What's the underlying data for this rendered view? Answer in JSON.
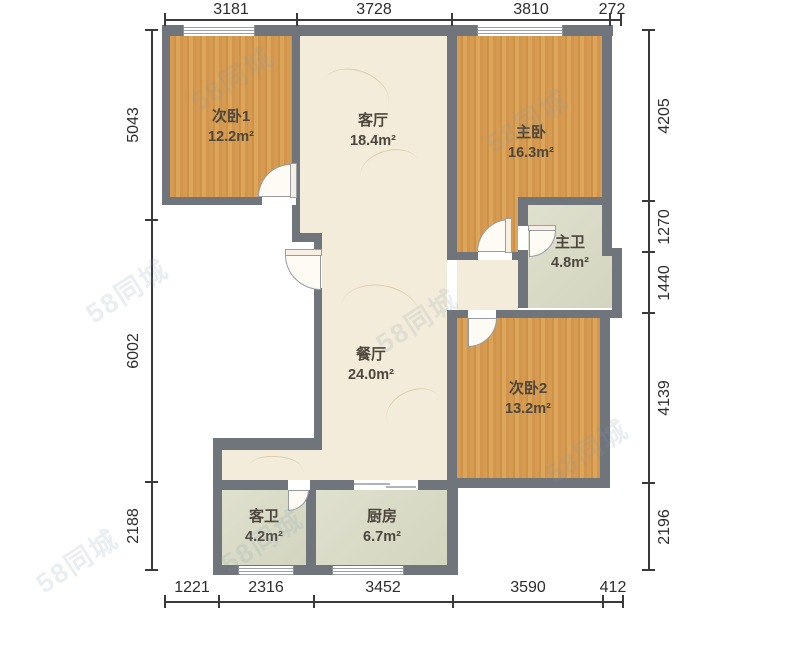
{
  "title": "两室两厅户型图",
  "watermark": {
    "text": "58同城"
  },
  "rooms": [
    {
      "id": "second-bedroom-1",
      "name": "次卧1",
      "area": "12.2m²"
    },
    {
      "id": "living-room",
      "name": "客厅",
      "area": "18.4m²"
    },
    {
      "id": "master-bedroom",
      "name": "主卧",
      "area": "16.3m²"
    },
    {
      "id": "master-bathroom",
      "name": "主卫",
      "area": "4.8m²"
    },
    {
      "id": "dining-room",
      "name": "餐厅",
      "area": "24.0m²"
    },
    {
      "id": "second-bedroom-2",
      "name": "次卧2",
      "area": "13.2m²"
    },
    {
      "id": "guest-bathroom",
      "name": "客卫",
      "area": "4.2m²"
    },
    {
      "id": "kitchen",
      "name": "厨房",
      "area": "6.7m²"
    }
  ],
  "dimensions": {
    "top": [
      "3181",
      "3728",
      "3810",
      "272"
    ],
    "bottom": [
      "1221",
      "2316",
      "3452",
      "3590",
      "412"
    ],
    "left": [
      "5043",
      "6002",
      "2188"
    ],
    "right": [
      "4205",
      "1270",
      "1440",
      "4139",
      "2196"
    ]
  },
  "colors": {
    "wall": "#70747b",
    "wood_floor": "#d49a52",
    "marble_floor": "#f3ecda",
    "tile_floor": "#dadcc7",
    "dimension_text": "#2d2d2d"
  }
}
